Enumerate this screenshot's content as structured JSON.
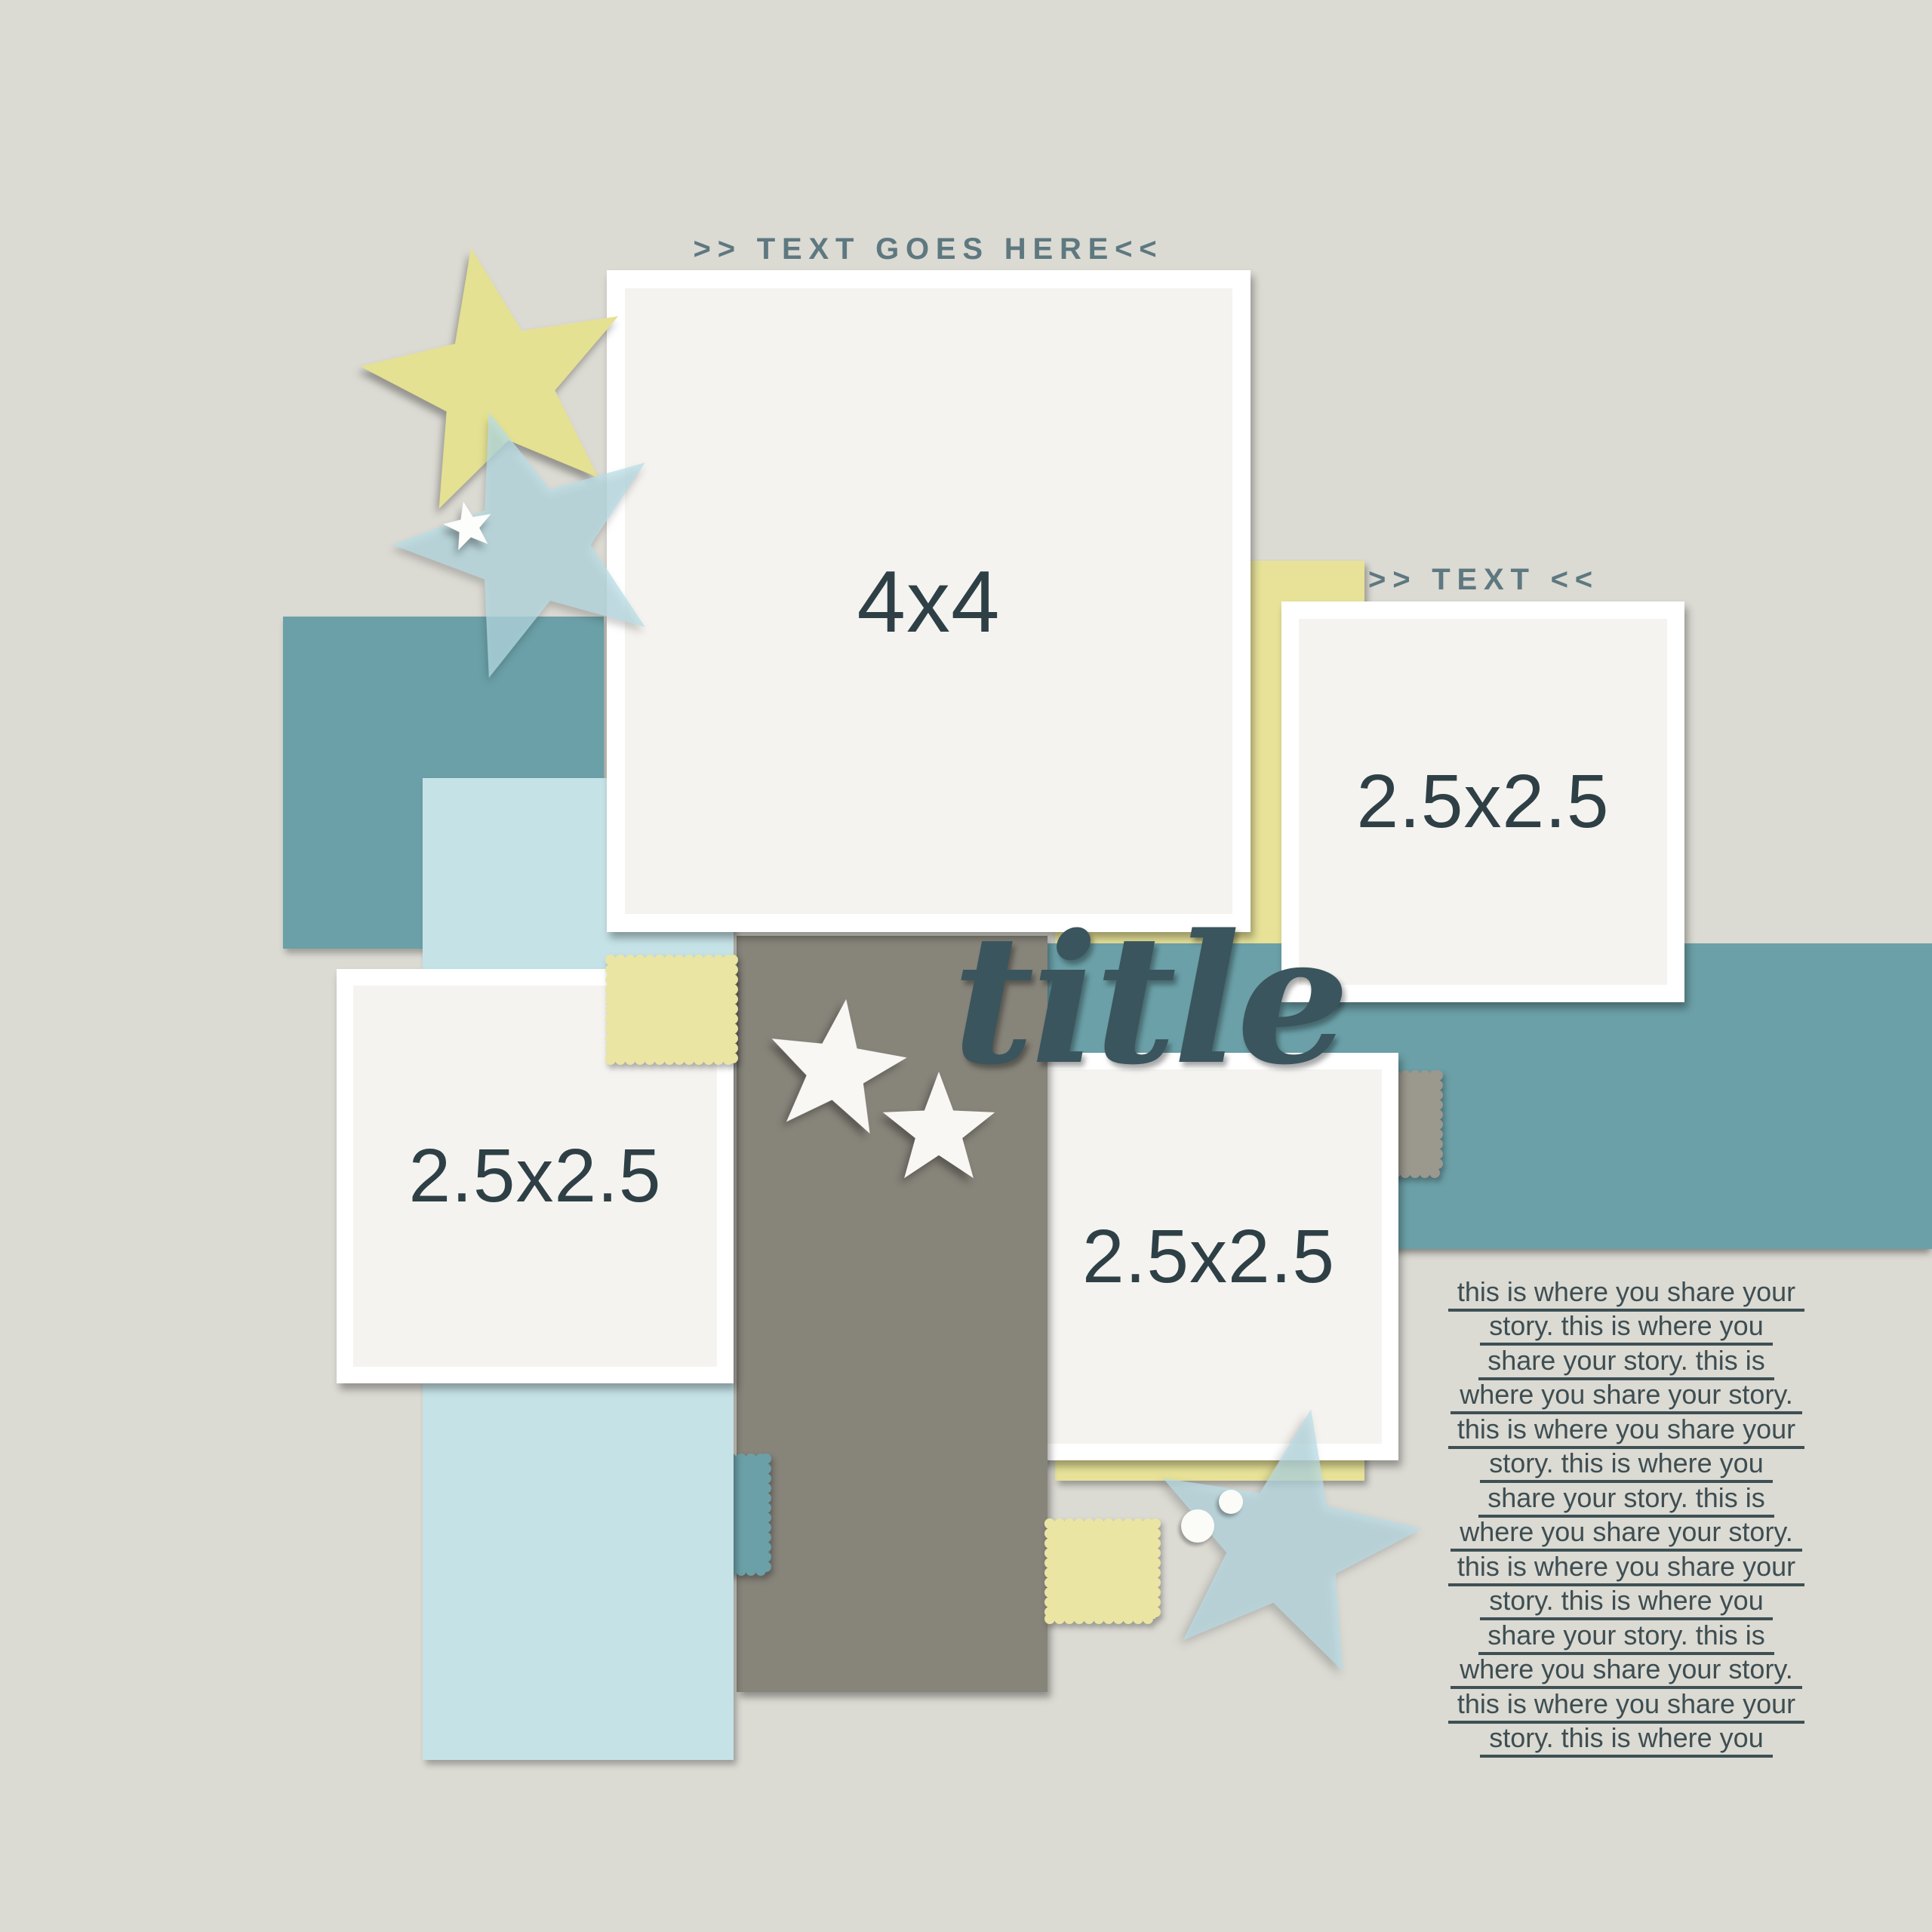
{
  "page": {
    "type": "scrapbook-layout-template",
    "background_color": "#dbdad3"
  },
  "palette": {
    "teal": "#6ba0a8",
    "yellow": "#e7e298",
    "light_blue": "#c5e3e7",
    "gray": "#87847a",
    "photo_placeholder": "#f4f3ef",
    "frame_white": "#ffffff",
    "label_dark": "#2e4046",
    "title_color": "#3a555d",
    "header_color": "#5e7880",
    "journal_color": "#3e4e52"
  },
  "headers": {
    "top_label": ">> TEXT GOES HERE<<",
    "right_label": ">> TEXT <<"
  },
  "title": {
    "text": "title"
  },
  "frames": {
    "photo_4x4": {
      "label": "4x4"
    },
    "photo_left": {
      "label": "2.5x2.5"
    },
    "photo_right": {
      "label": "2.5x2.5"
    },
    "photo_center": {
      "label": "2.5x2.5"
    }
  },
  "journal": {
    "lines": [
      "this is where you share your",
      "story. this is where you",
      "share your story. this is",
      "where you share your story.",
      "this is where you share your",
      "story. this is where you",
      "share your story. this is",
      "where you share your story.",
      "this is where you share your",
      "story. this is where you",
      "share your story. this is",
      "where you share your story.",
      "this is where you share your",
      "story. this is where you"
    ]
  },
  "icons": {
    "star_shapes": [
      "yellow-star-icon",
      "blue-star-icon",
      "white-star-icon"
    ],
    "stamp_shapes": [
      "yellow-stamp-icon",
      "teal-stamp-icon",
      "gray-stamp-icon"
    ]
  }
}
